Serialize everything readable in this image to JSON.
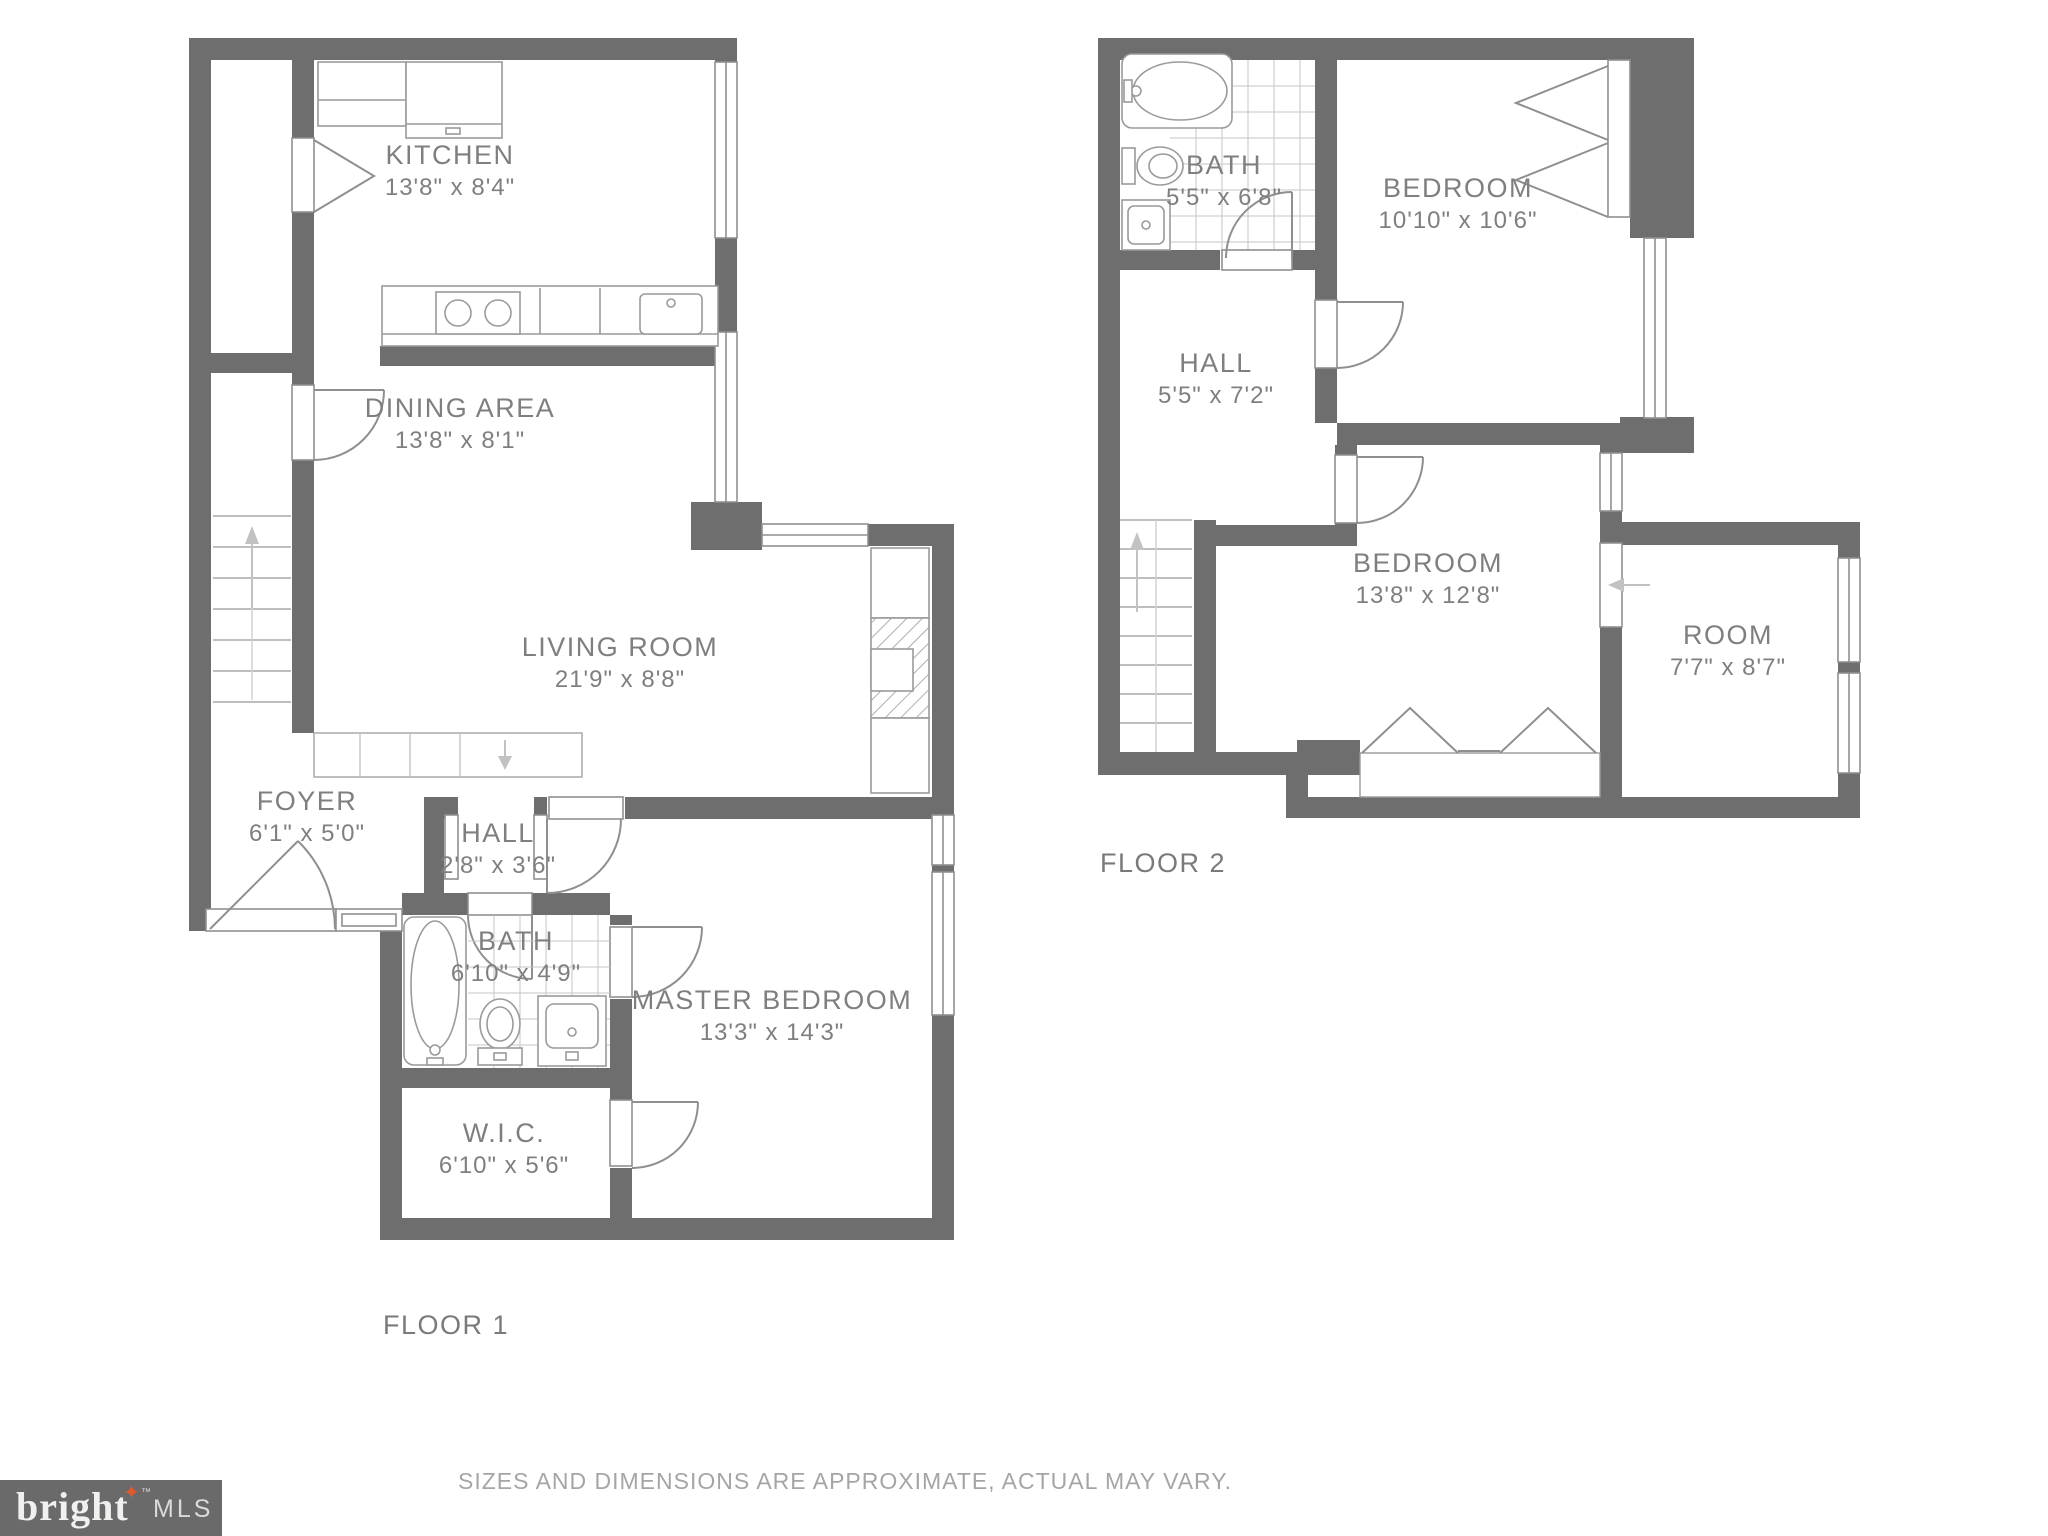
{
  "floors": [
    {
      "label": "FLOOR 1",
      "rooms": [
        {
          "name": "KITCHEN",
          "dims": "13'8\" x 8'4\""
        },
        {
          "name": "DINING AREA",
          "dims": "13'8\" x 8'1\""
        },
        {
          "name": "LIVING ROOM",
          "dims": "21'9\" x 8'8\""
        },
        {
          "name": "FOYER",
          "dims": "6'1\" x 5'0\""
        },
        {
          "name": "HALL",
          "dims": "2'8\" x 3'6\""
        },
        {
          "name": "BATH",
          "dims": "6'10\" x 4'9\""
        },
        {
          "name": "MASTER BEDROOM",
          "dims": "13'3\" x 14'3\""
        },
        {
          "name": "W.I.C.",
          "dims": "6'10\" x 5'6\""
        }
      ]
    },
    {
      "label": "FLOOR 2",
      "rooms": [
        {
          "name": "BATH",
          "dims": "5'5\" x 6'8\""
        },
        {
          "name": "BEDROOM",
          "dims": "10'10\" x 10'6\""
        },
        {
          "name": "HALL",
          "dims": "5'5\" x 7'2\""
        },
        {
          "name": "BEDROOM",
          "dims": "13'8\" x 12'8\""
        },
        {
          "name": "ROOM",
          "dims": "7'7\" x 8'7\""
        }
      ]
    }
  ],
  "footer": {
    "disclaimer": "SIZES AND DIMENSIONS ARE APPROXIMATE, ACTUAL MAY VARY."
  },
  "logo": {
    "brand": "bright",
    "tm": "™",
    "suffix": "MLS"
  },
  "colors": {
    "wall": "#6e6e6e",
    "line": "#8f8f8f",
    "fixture": "#9a9a9a",
    "tile": "#c6c6c6",
    "text": "#7f7f7f",
    "muted": "#a5a5a5",
    "logo_bg": "#6a6a6a",
    "logo_star": "#e05a2b"
  }
}
